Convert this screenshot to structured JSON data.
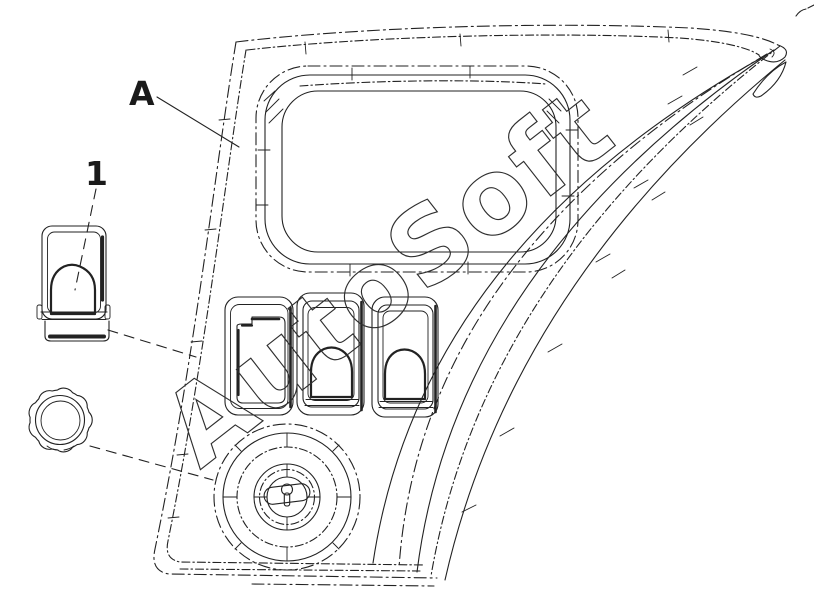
{
  "figure": {
    "type": "parts-line-drawing",
    "labels": {
      "a": "A",
      "part1": "1"
    },
    "watermark": {
      "text": "AutoSoft"
    },
    "colors": {
      "background": "#ffffff",
      "line": "#222222",
      "watermark_outline": "#2f2f2f",
      "callout_text": "#1a1a1a"
    }
  }
}
